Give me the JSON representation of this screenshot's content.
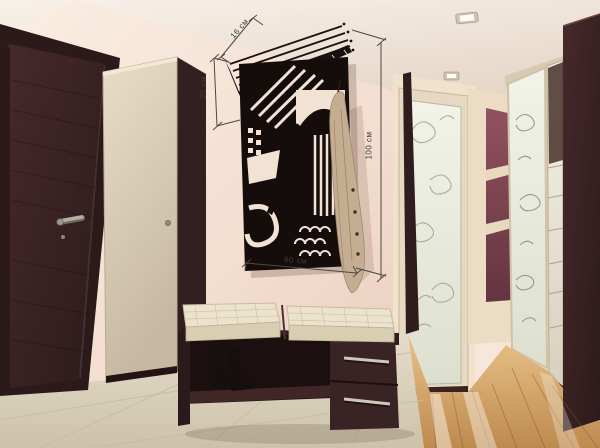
{
  "scene": {
    "labels": {
      "shelf_depth": "16 см",
      "shelf_height": "25 см",
      "panel_height": "100 см",
      "panel_width": "60 см"
    },
    "colors": {
      "ceiling": "#f2eadf",
      "wall": "#f6e7da",
      "wall-deep": "#eccfc0",
      "wenge": "#382122",
      "wenge-deep": "#241314",
      "maroon": "#7e4450",
      "cream-furniture": "#ddd1ba",
      "cushion": "#eae0c8",
      "tile": "#ddd4bf",
      "wood": "#d2a067",
      "panel-black": "#140d0b",
      "garment": "#c4ad90",
      "metal": "#c8c2b6",
      "dimension-line": "#4c4842",
      "glass": "#eef0e4"
    }
  }
}
